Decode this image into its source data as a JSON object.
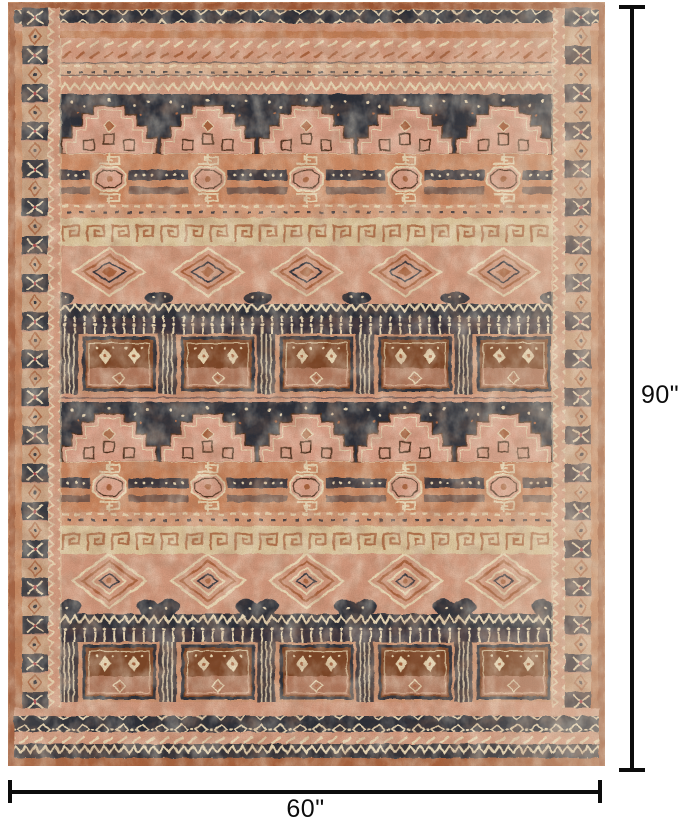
{
  "product_image": {
    "subject": "Vintage tribal-style area rug with repeating geometric temple, medallion and diamond bands",
    "palette": {
      "base": "#c07a52",
      "pink": "#d49a7f",
      "blush": "#dca28b",
      "tan": "#d8ad8e",
      "cream": "#ead9b5",
      "navy": "#2c2e39",
      "rust": "#a9623d",
      "brown": "#7c4526",
      "darkline": "#4a2e1e",
      "crimson": "#a83a44",
      "line": "#0c0c0c"
    }
  },
  "annotations": {
    "height_label": "90\"",
    "width_label": "60\""
  }
}
